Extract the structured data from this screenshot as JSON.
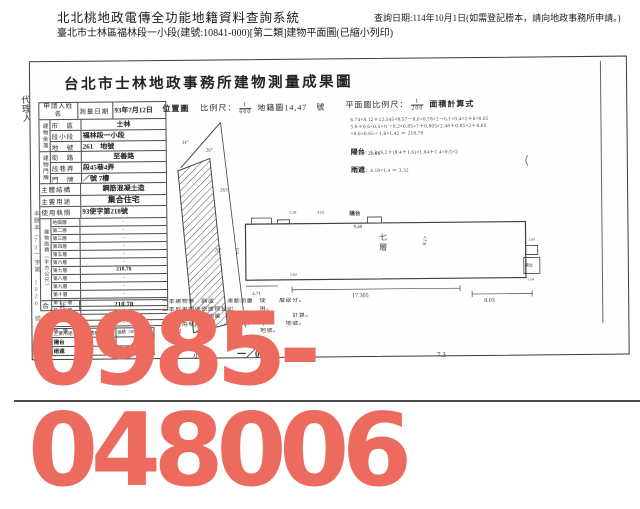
{
  "header": {
    "system_title": "北北桃地政電傳全功能地籍資料查詢系統",
    "query_date": "查詢日期:114年10月1日(如需登記謄本，請向地政事務所申請。)",
    "subtitle": "臺北市士林區福林段一小段(建號:10841-000)[第二類]建物平面圖(已縮小列印)"
  },
  "watermark": {
    "text": "0985-048006",
    "color": "#ed6a5e"
  },
  "doc": {
    "title": "台北市士林地政事務所建物測量成果圖",
    "agent_label": "代理人",
    "stamp": "本謄本（73）字第 1020 號",
    "applicant_label": "申請人姓名",
    "survey_label": "測量日期",
    "survey_value": "93年7月12日",
    "location_group": "建物坐落",
    "loc": [
      {
        "label": "市　區",
        "value": "士林"
      },
      {
        "label": "段小段",
        "value": "福林段一小段"
      },
      {
        "label": "地　號",
        "value": "261　地號"
      }
    ],
    "address_group": "建物門牌",
    "addr": [
      {
        "label": "街　路",
        "value": "至善路"
      },
      {
        "label": "段巷弄",
        "value": "段45巷4弄"
      },
      {
        "label": "門　牌",
        "value": "／號 7樓"
      }
    ],
    "attrs": [
      {
        "label": "主體結構",
        "value": "鋼筋混凝土造"
      },
      {
        "label": "主要用途",
        "value": "集合住宅"
      },
      {
        "label": "使用執照",
        "value": "93使字第218號"
      }
    ],
    "area_group": "建物面積（平方公尺）",
    "floors": [
      {
        "label": "地面層",
        "value": "-"
      },
      {
        "label": "第二層",
        "value": "-"
      },
      {
        "label": "第三層",
        "value": "-"
      },
      {
        "label": "第四層",
        "value": "-"
      },
      {
        "label": "第五層",
        "value": "-"
      },
      {
        "label": "第六層",
        "value": "-"
      },
      {
        "label": "第七層",
        "value": "218.78"
      },
      {
        "label": "第八層",
        "value": "-"
      },
      {
        "label": "第九層",
        "value": "-"
      },
      {
        "label": "第十層",
        "value": "-"
      },
      {
        "label": "第十一層",
        "value": "-"
      },
      {
        "label": "第十二層",
        "value": "-"
      },
      {
        "label": "",
        "value": "-"
      },
      {
        "label": "",
        "value": "-"
      },
      {
        "label": "騎　樓",
        "value": "-"
      }
    ],
    "total_label": "合　計",
    "total_value": "218.78",
    "annex_group": "附屬建物",
    "annex_headers": [
      "主要用途",
      "主體構造",
      "面積（平方公尺）"
    ],
    "annex_rows": [
      {
        "use": "陽台",
        "structure": "",
        "area": ""
      },
      {
        "use": "雨遮",
        "structure": "",
        "area": ""
      }
    ],
    "locmap": {
      "title": "位置圖",
      "scale_label": "比例尺：",
      "num": "1",
      "den": "600",
      "sheet": "地籍圖14,47　號",
      "a1": "34°",
      "a2": "26°",
      "a3": "263",
      "a4": "26°"
    },
    "plan": {
      "scale_label": "平面圖比例尺：",
      "num": "1",
      "den": "200",
      "calc_title": "面積計算式",
      "calc1": "6.74×8.12＋12.345×8.57－8.6×0.78×2－6.1×0.4×2＋6×8.05",
      "calc2": "5.8＋0.6×0.5×½－0.2×0.85×7＋0.805×2.48＋0.05×2＋0.65",
      "calc3": "×0.6×0.65－1.6×1.42 ＝ 218.78",
      "balcony_label": "陽台",
      "balcony_calc": "：1.2×9.2＋(8.4＋1.6)×1.04＋1.4×0.5×2",
      "balcony_total": "＝ 22.06",
      "canopy_label": "雨遮",
      "canopy_calc": "：4.18×1.4 ＝ 3.32",
      "top_balcony": "陽台",
      "floor_label": "七層",
      "right_balcony": "陽台",
      "d_940": "9.40",
      "d_17305": "17.305",
      "d_803": "8.03",
      "d_471": "4.71",
      "d_817": "8.17",
      "d_528": "5.28",
      "d_462": "4.62",
      "d_260": "2.60",
      "d_104": "1.04",
      "d_851": "8.51",
      "d_562": "5.62"
    },
    "notes": [
      "一本建物係　鋼造　　運動測量　使　　層部分。",
      "二本成果圖係依建物登記　　　　用。",
      "　　次登記僅動測量　　　　動測建物　　　計算。",
      "　　使用執照（字　　號　2/8　　）　　　地號。",
      "　　段　　　小段　　　　　　　地號。"
    ],
    "stray": "（",
    "footer": [
      "小段",
      "一／08",
      "7.3"
    ]
  }
}
